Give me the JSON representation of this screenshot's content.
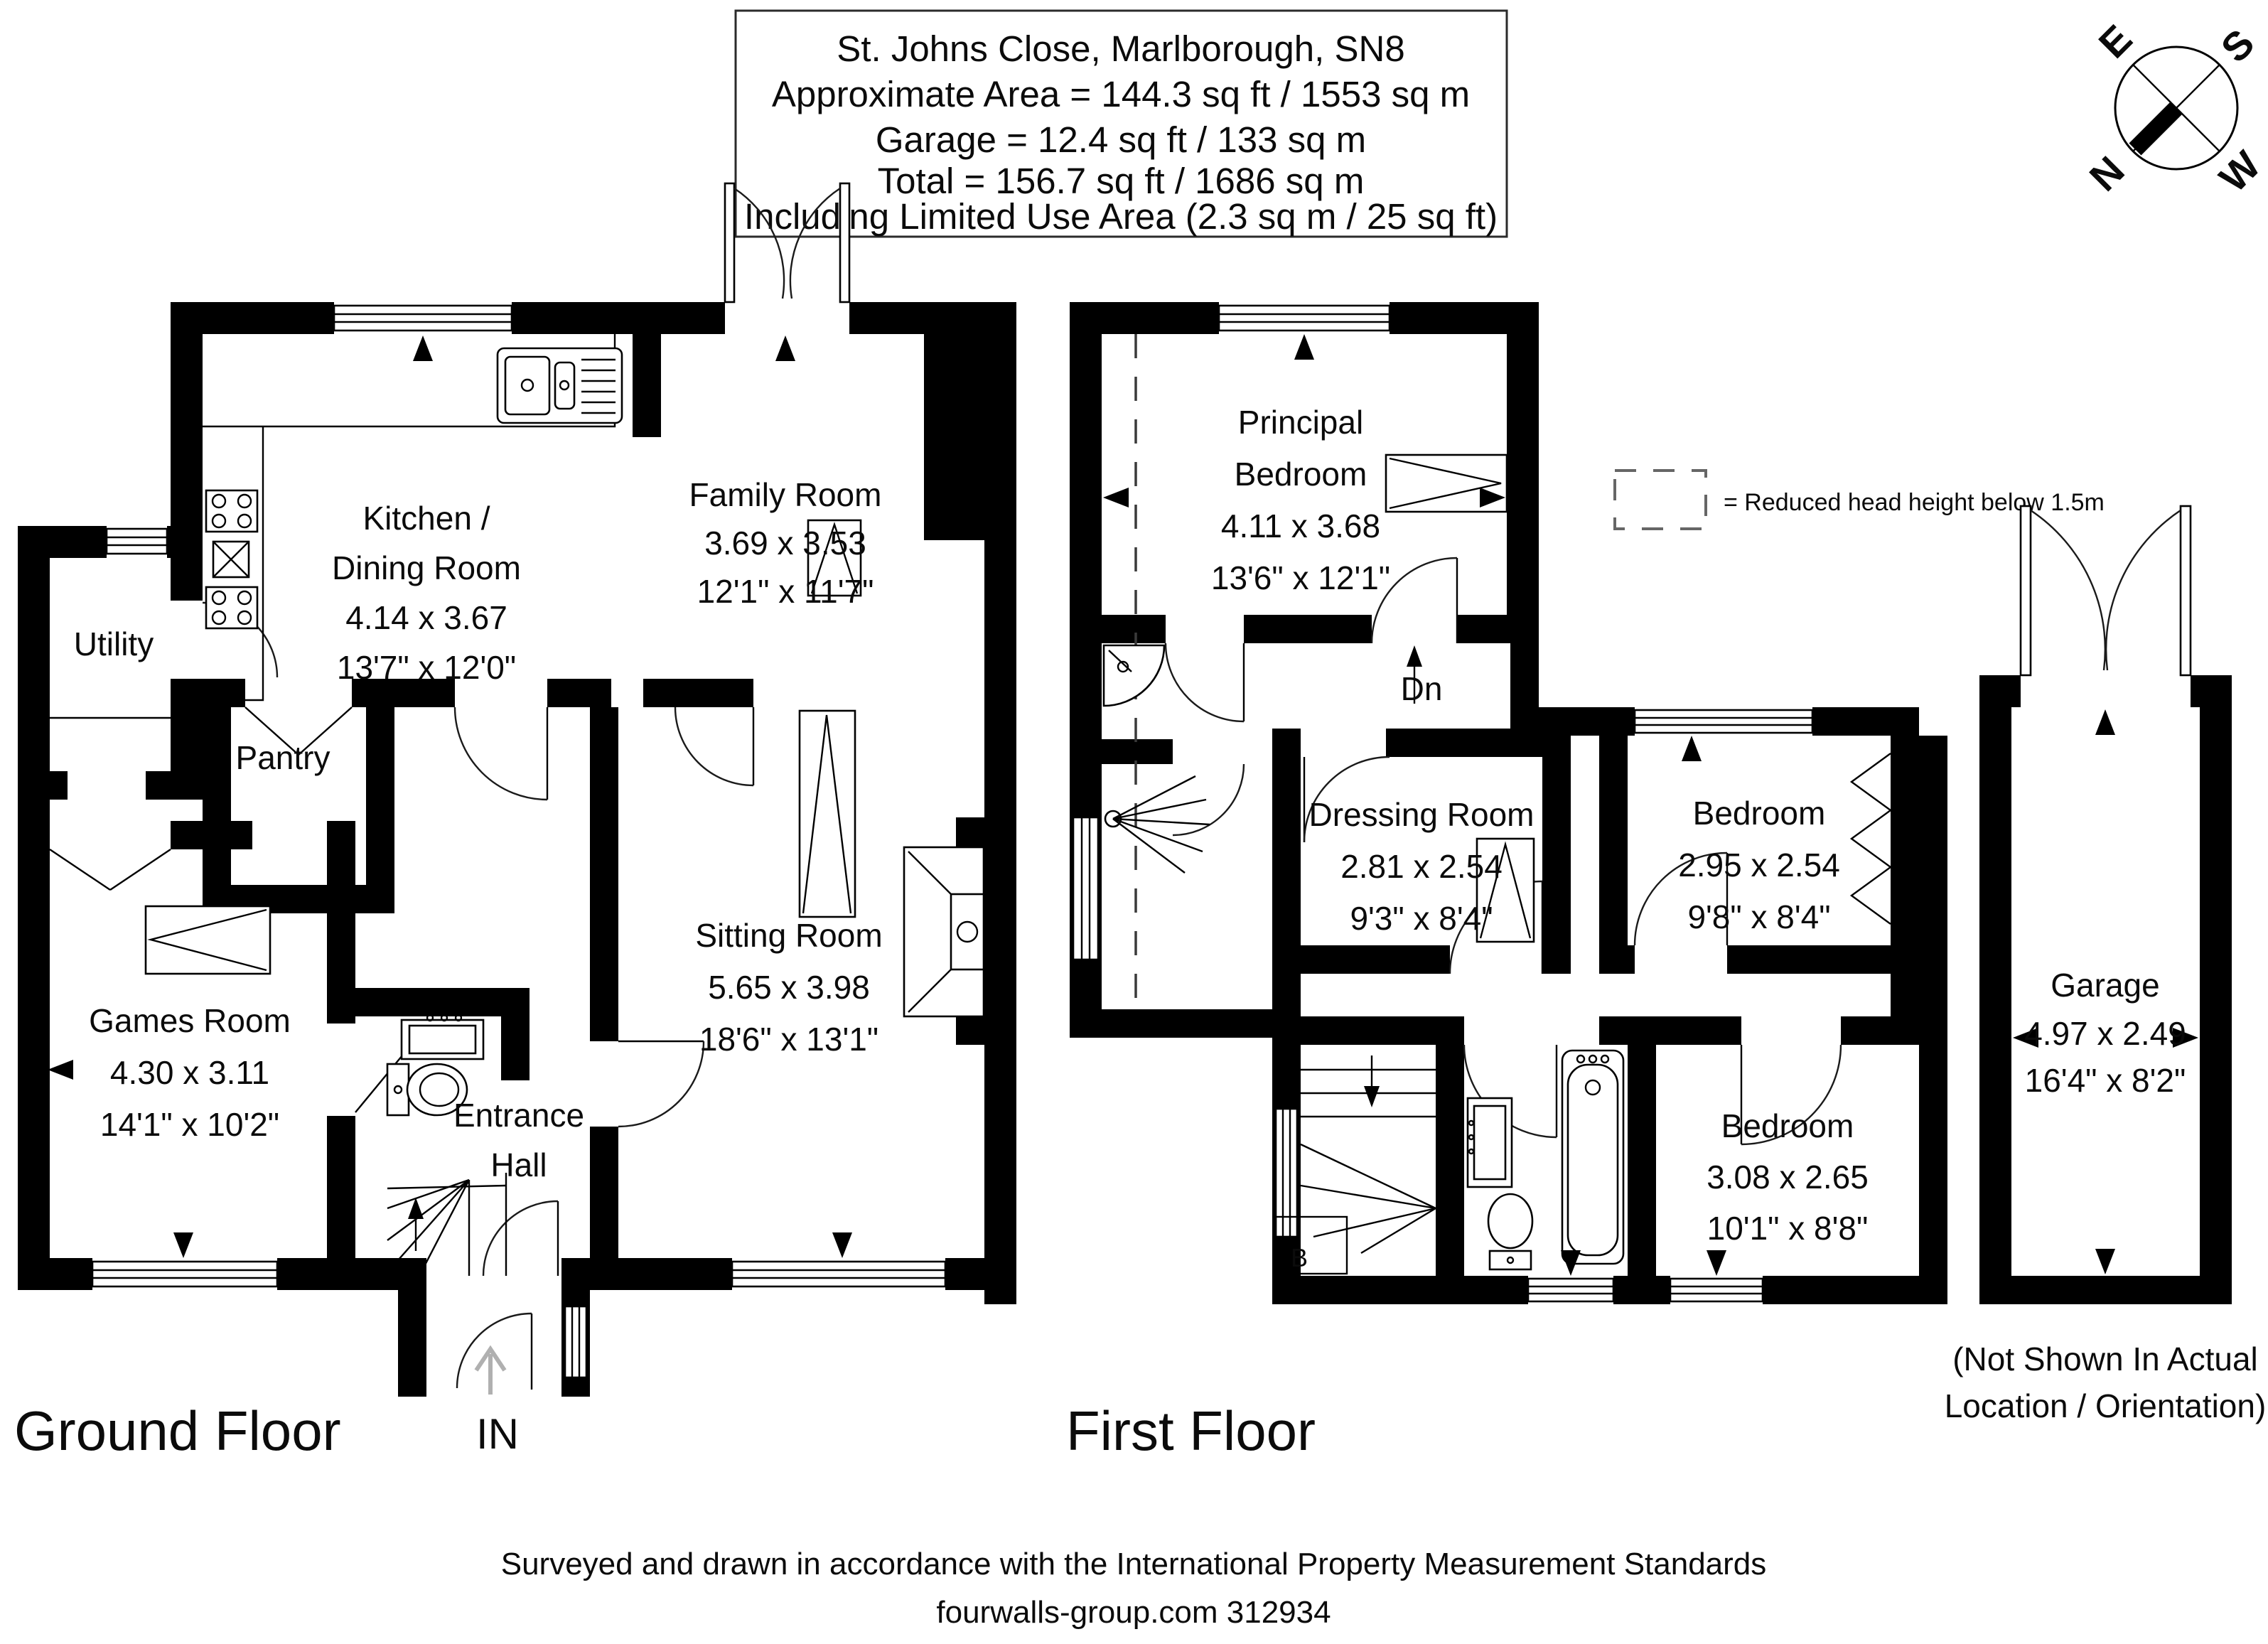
{
  "title": {
    "l1": "St. Johns Close, Marlborough, SN8",
    "l2": "Approximate Area = 144.3 sq ft / 1553 sq m",
    "l3": "Garage = 12.4 sq ft / 133 sq m",
    "l4": "Total = 156.7 sq ft / 1686 sq m",
    "l5": "Including Limited Use Area (2.3 sq m / 25 sq ft)"
  },
  "compass": {
    "n": "N",
    "e": "E",
    "s": "S",
    "w": "W"
  },
  "legend": {
    "label": "= Reduced head height below 1.5m"
  },
  "floor_labels": {
    "ground": "Ground Floor",
    "first": "First Floor"
  },
  "annotations": {
    "in_label": "IN",
    "down": "Dn",
    "boiler": "B"
  },
  "rooms": {
    "kitchen": {
      "n1": "Kitchen /",
      "n2": "Dining Room",
      "m": "4.14 x 3.67",
      "i": "13'7\" x 12'0\""
    },
    "family": {
      "n": "Family Room",
      "m": "3.69 x 3.53",
      "i": "12'1\" x 11'7\""
    },
    "utility": {
      "n": "Utility"
    },
    "pantry": {
      "n": "Pantry"
    },
    "games": {
      "n": "Games Room",
      "m": "4.30 x 3.11",
      "i": "14'1\" x 10'2\""
    },
    "sitting": {
      "n": "Sitting Room",
      "m": "5.65 x 3.98",
      "i": "18'6\" x 13'1\""
    },
    "hall": {
      "n1": "Entrance",
      "n2": "Hall"
    },
    "principal": {
      "n1": "Principal",
      "n2": "Bedroom",
      "m": "4.11 x 3.68",
      "i": "13'6\" x 12'1\""
    },
    "dressing": {
      "n": "Dressing Room",
      "m": "2.81 x 2.54",
      "i": "9'3\" x 8'4\""
    },
    "bedroom2": {
      "n": "Bedroom",
      "m": "2.95 x 2.54",
      "i": "9'8\" x 8'4\""
    },
    "bedroom3": {
      "n": "Bedroom",
      "m": "3.08 x 2.65",
      "i": "10'1\" x 8'8\""
    },
    "garage": {
      "n": "Garage",
      "m": "4.97 x 2.49",
      "i": "16'4\" x 8'2\"",
      "note1": "(Not Shown In Actual",
      "note2": "Location / Orientation)"
    }
  },
  "footer": {
    "l1": "Surveyed and drawn in accordance with the International Property Measurement Standards",
    "l2": "fourwalls-group.com 312934"
  }
}
